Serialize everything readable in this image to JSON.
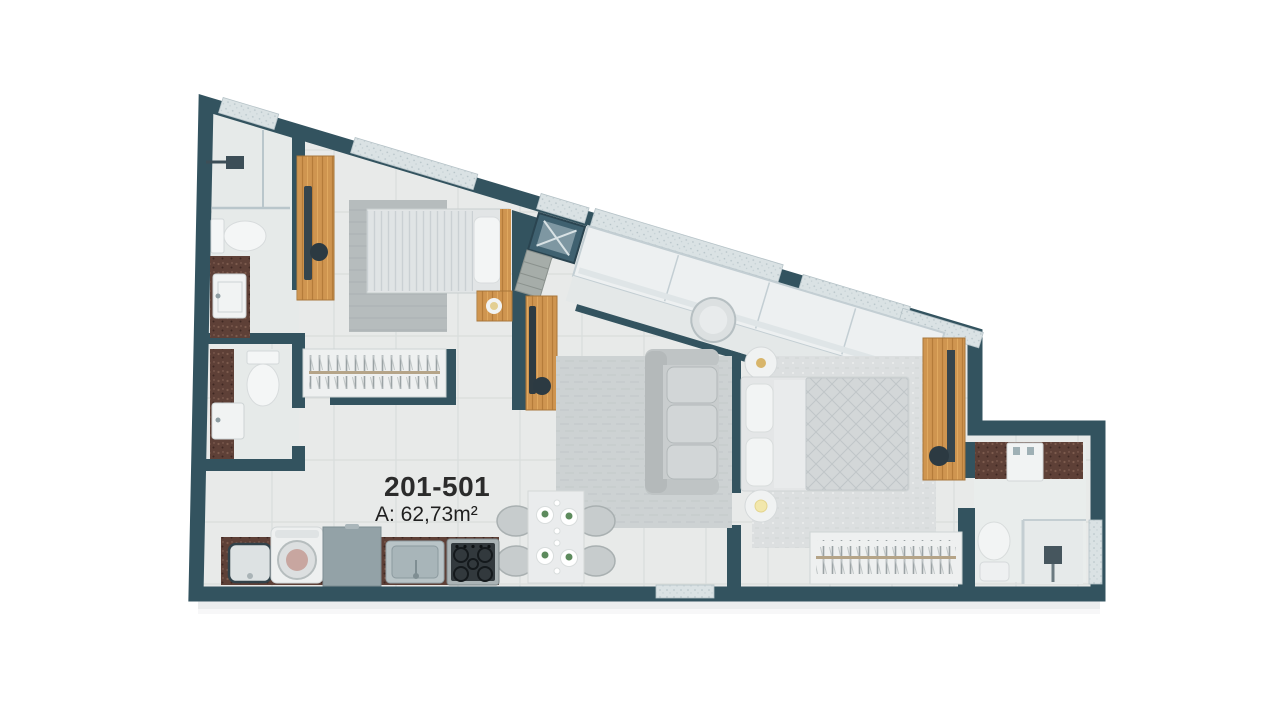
{
  "unit": {
    "id": "201-501",
    "area_label": "A: 62,73m²"
  },
  "palette": {
    "background": "#ffffff",
    "wall": "#33535f",
    "floor": "#e8eae9",
    "tile_line": "#d9dddc",
    "wood": "#cf9550",
    "stone_counter": "#5e4037",
    "window_sill": "#dae2e4",
    "glass": "#edf0f1",
    "furniture_gray": "#c6cacb",
    "text": "#2b2b2b"
  },
  "rooms": [
    {
      "name": "bathroom-top-left",
      "furniture": [
        "shower",
        "toilet",
        "sink-counter"
      ]
    },
    {
      "name": "bathroom-mid-left",
      "furniture": [
        "toilet",
        "sink-counter"
      ]
    },
    {
      "name": "bedroom-single",
      "furniture": [
        "wardrobe",
        "single-bed",
        "rug",
        "nightstand-lamp",
        "tv-panel"
      ]
    },
    {
      "name": "hall",
      "furniture": [
        "open-clothes-rack"
      ]
    },
    {
      "name": "balcony-corridor",
      "furniture": [
        "duct-shaft",
        "entry-landing",
        "glazing",
        "round-table"
      ]
    },
    {
      "name": "living-dining",
      "furniture": [
        "sofa",
        "rug",
        "dining-table",
        "dining-chairs",
        "plates"
      ]
    },
    {
      "name": "kitchen",
      "furniture": [
        "laundry-sink",
        "washing-machine",
        "refrigerator",
        "kitchen-sink",
        "cooktop",
        "stone-counter"
      ]
    },
    {
      "name": "bedroom-master",
      "furniture": [
        "double-bed",
        "rug",
        "bedside-tables",
        "wardrobe",
        "open-clothes-rack"
      ]
    },
    {
      "name": "bathroom-ensuite",
      "furniture": [
        "sink-counter",
        "toilet",
        "shower-enclosure",
        "window"
      ]
    }
  ]
}
